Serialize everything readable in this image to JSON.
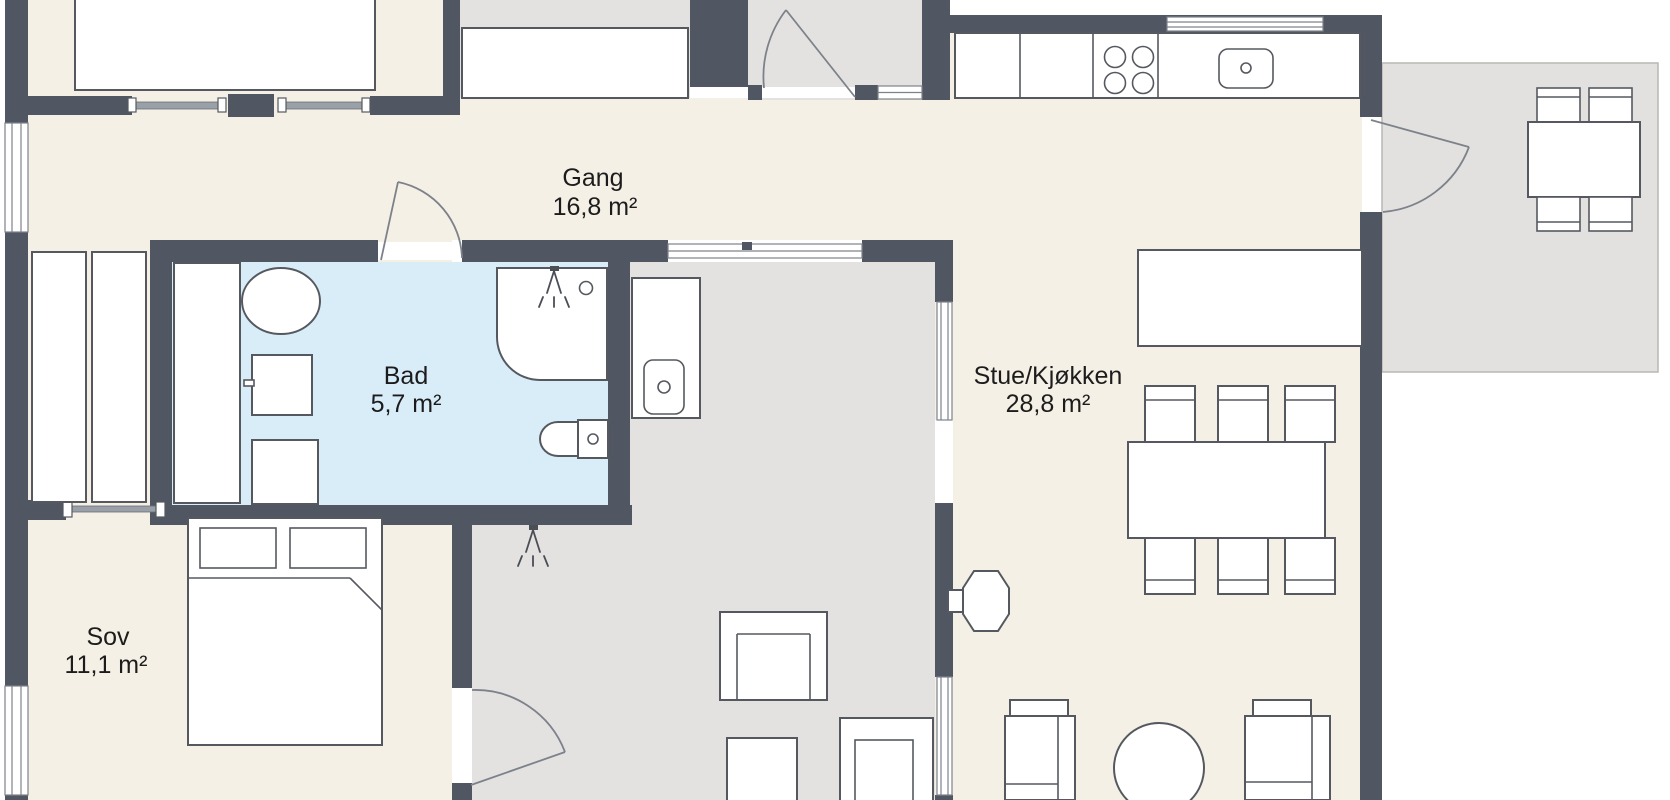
{
  "plan": {
    "language": "Norwegian",
    "rooms": [
      {
        "name": "Gang",
        "area": "16,8 m²"
      },
      {
        "name": "Bad",
        "area": "5,7 m²"
      },
      {
        "name": "Sov",
        "area": "11,1 m²"
      },
      {
        "name": "Stue/Kjøkken",
        "area": "28,8 m²"
      }
    ],
    "colors": {
      "wall": "#515762",
      "floor_main": "#f5f0e6",
      "floor_bath": "#d9edf8",
      "floor_secondary": "#e3e2e0",
      "background": "#ffffff",
      "furniture_stroke": "#55595f"
    },
    "icons": [
      "bed-icon",
      "pillow-icon",
      "wardrobe-icon",
      "washbasin-icon",
      "washing-machine-icon",
      "toilet-icon",
      "shower-icon",
      "shower-head-icon",
      "drain-icon",
      "sink-icon",
      "stove-burners-icon",
      "kitchen-counter-icon",
      "kitchen-island-icon",
      "dining-table-icon",
      "chair-icon",
      "armchair-icon",
      "sofa-icon",
      "coffee-table-icon",
      "fireplace-icon",
      "door-swing-icon",
      "sliding-door-icon",
      "window-icon",
      "outdoor-table-icon"
    ]
  }
}
